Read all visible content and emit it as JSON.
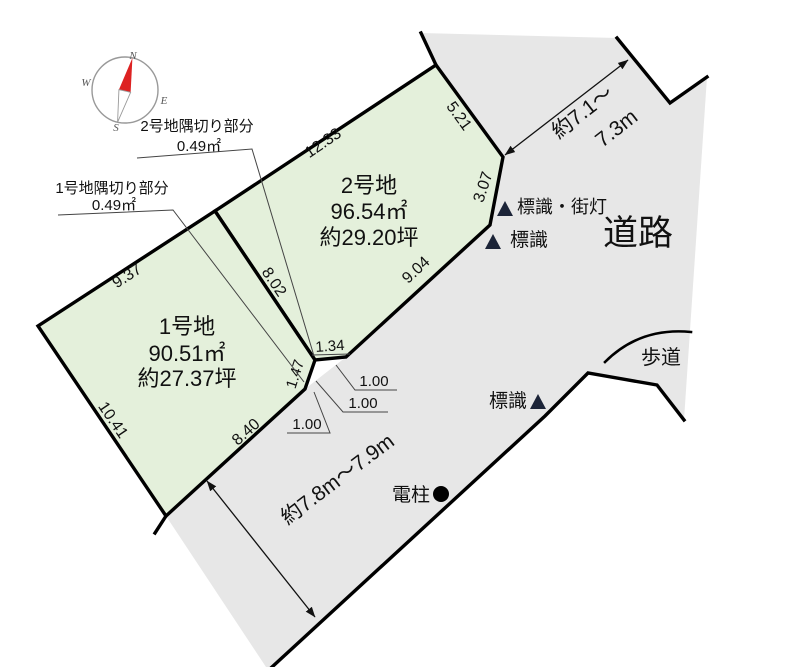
{
  "colors": {
    "parcel_fill": "#e4f0db",
    "road_fill": "#e7e7e7",
    "boundary": "#000000",
    "needle_red": "#dd2222",
    "marker_navy": "#1c2438",
    "text": "#111111"
  },
  "compass": {
    "n": "N",
    "e": "E",
    "s": "S",
    "w": "W"
  },
  "lot1": {
    "name": "1号地",
    "area_m2": "90.51㎡",
    "area_tsubo": "約27.37坪"
  },
  "lot2": {
    "name": "2号地",
    "area_m2": "96.54㎡",
    "area_tsubo": "約29.20坪"
  },
  "cut1": {
    "line1": "1号地隅切り部分",
    "line2": "0.49㎡"
  },
  "cut2": {
    "line1": "2号地隅切り部分",
    "line2": "0.49㎡"
  },
  "dims": {
    "e1233": "12.33",
    "e937": "9.37",
    "e521": "5.21",
    "e307": "3.07",
    "e904": "9.04",
    "e802": "8.02",
    "e1041": "10.41",
    "e840": "8.40",
    "e134": "1.34",
    "e147": "1.47",
    "one_a": "1.00",
    "one_b": "1.00",
    "one_c": "1.00"
  },
  "road": {
    "name": "道路",
    "sidewalk": "歩道",
    "width_top_1": "約7.1～",
    "width_top_2": "7.3m",
    "width_bottom": "約7.8m～7.9m"
  },
  "features": {
    "sign_streetlight": "標識・街灯",
    "sign_upper": "標識",
    "sign_lower": "標識",
    "pole": "電柱"
  }
}
